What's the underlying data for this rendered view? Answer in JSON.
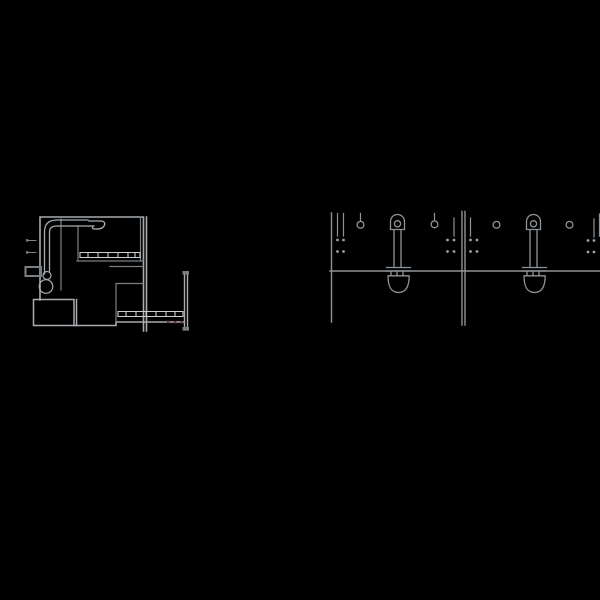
{
  "canvas": {
    "width": 600,
    "height": 600,
    "background": "#000000"
  },
  "palette": {
    "plan_line": "#a8acb0",
    "plan_line_soft": "#7a7f83",
    "plan_line_bright": "#c9cdd0",
    "red_mark": "#6e2823",
    "elev_line": "#8f9498",
    "dot": "#9aa0a4"
  },
  "plan": {
    "label": "plan-view-drawing",
    "features": [
      "outer walls",
      "interior partition",
      "hatched counter shelf",
      "corner pipe run with elbow",
      "curved hook detail",
      "wall-mounted fixtures",
      "dimension ticks",
      "floor cabinet box",
      "lower room with hatched shelf",
      "door leaf double line",
      "red detail marks"
    ]
  },
  "elevation": {
    "label": "elevation-view-drawing",
    "bay_count": 2,
    "pendant_count": 2,
    "hanger_ring_count": 4,
    "fastener_dot_clusters": 4,
    "fixtures": [
      "wall anchor lines",
      "fastener dots",
      "hanger rings",
      "pendant bracket with hanging bucket"
    ]
  }
}
